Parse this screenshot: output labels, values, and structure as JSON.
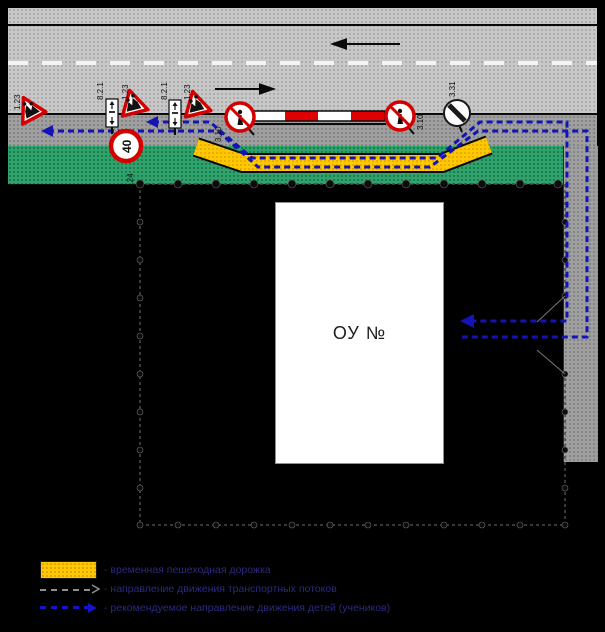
{
  "building": {
    "label": "ОУ №"
  },
  "signs": {
    "children_code": "1.23",
    "zone_plate_code": "8.2.1",
    "speed_limit_code": "3.24",
    "speed_limit_value": "40",
    "no_pedestrians_code": "3.10",
    "end_restrictions_code": "3.31"
  },
  "legend": {
    "items": [
      {
        "label": "- временная пешеходная дорожка"
      },
      {
        "label": "- направление движения транспортных потоков"
      },
      {
        "label": "- рекомендуемое направление движения детей (учеников)"
      }
    ]
  },
  "colors": {
    "walkway_yellow": "#ffc800",
    "route_blue": "#1414b4",
    "lawn_green": "#2ea36b",
    "barrier_red": "#e00000",
    "sign_red": "#d40000"
  }
}
